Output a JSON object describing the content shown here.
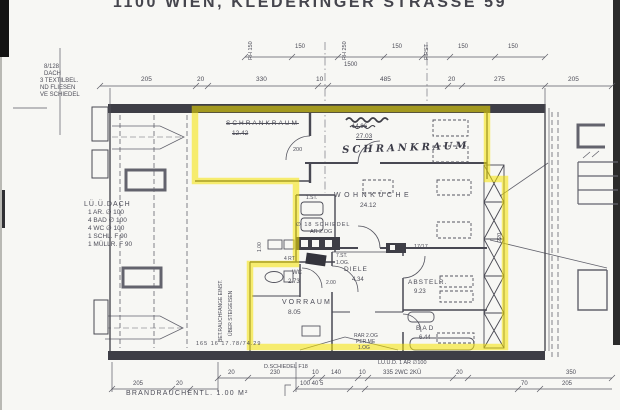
{
  "title": "1100 WIEN, KLEDERINGER STRASSE 59",
  "highlight_color": "#f6e400",
  "ink_color": "#4d4d58",
  "labels": [
    {
      "name": "note-roof-line1",
      "text": "8/128",
      "x": 44,
      "y": 64,
      "size": 6
    },
    {
      "name": "note-roof-line2",
      "text": "DACH",
      "x": 44,
      "y": 71,
      "size": 6
    },
    {
      "name": "note-roof-line3",
      "text": "3 TEXTILBEL.",
      "x": 40,
      "y": 78,
      "size": 6
    },
    {
      "name": "note-roof-line4",
      "text": "ND FLIESEN",
      "x": 40,
      "y": 85,
      "size": 6
    },
    {
      "name": "note-roof-line5",
      "text": "VE SCHIEDEL",
      "x": 40,
      "y": 92,
      "size": 6
    },
    {
      "name": "note-vent-line1",
      "text": "LÜ.Ü.DACH",
      "x": 84,
      "y": 201,
      "size": 7,
      "sp": 1
    },
    {
      "name": "note-vent-line2",
      "text": "1 AR. ∅ 100",
      "x": 88,
      "y": 210,
      "size": 6.5
    },
    {
      "name": "note-vent-line3",
      "text": "4 BAD ∅ 100",
      "x": 88,
      "y": 218,
      "size": 6.5
    },
    {
      "name": "note-vent-line4",
      "text": "4 WC ∅ 100",
      "x": 88,
      "y": 226,
      "size": 6.5
    },
    {
      "name": "note-vent-line5",
      "text": "1 SCHL. F 90",
      "x": 88,
      "y": 234,
      "size": 6.5
    },
    {
      "name": "note-vent-line6",
      "text": "1 MÜLLR. F 90",
      "x": 88,
      "y": 242,
      "size": 6.5
    },
    {
      "name": "dim-rh150",
      "text": "RH 150",
      "x": 249,
      "y": 60,
      "size": 5.5,
      "rot": -90
    },
    {
      "name": "dim-150-a",
      "text": "150",
      "x": 295,
      "y": 44,
      "size": 6
    },
    {
      "name": "dim-rh250",
      "text": "RH 250",
      "x": 343,
      "y": 60,
      "size": 5.5,
      "rot": -90
    },
    {
      "name": "dim-150-b",
      "text": "150",
      "x": 392,
      "y": 44,
      "size": 6
    },
    {
      "name": "dim-first",
      "text": "FIRST",
      "x": 425,
      "y": 60,
      "size": 5.5,
      "rot": -90
    },
    {
      "name": "dim-150-c",
      "text": "150",
      "x": 458,
      "y": 44,
      "size": 6
    },
    {
      "name": "dim-150-d",
      "text": "150",
      "x": 508,
      "y": 44,
      "size": 6
    },
    {
      "name": "dim-1500",
      "text": "1500",
      "x": 344,
      "y": 62,
      "size": 6
    },
    {
      "name": "dim-top-205a",
      "text": "205",
      "x": 141,
      "y": 77,
      "size": 6.5
    },
    {
      "name": "dim-top-20a",
      "text": "20",
      "x": 197,
      "y": 77,
      "size": 6.5
    },
    {
      "name": "dim-top-330",
      "text": "330",
      "x": 256,
      "y": 77,
      "size": 6.5
    },
    {
      "name": "dim-top-10",
      "text": "10",
      "x": 316,
      "y": 77,
      "size": 6.5
    },
    {
      "name": "dim-top-485",
      "text": "485",
      "x": 380,
      "y": 77,
      "size": 6.5
    },
    {
      "name": "dim-top-20b",
      "text": "20",
      "x": 448,
      "y": 77,
      "size": 6.5
    },
    {
      "name": "dim-top-275",
      "text": "275",
      "x": 494,
      "y": 77,
      "size": 6.5
    },
    {
      "name": "dim-top-205b",
      "text": "205",
      "x": 568,
      "y": 77,
      "size": 6.5
    },
    {
      "name": "room-schrankraum1-label",
      "text": "SCHRANKRAUM",
      "x": 226,
      "y": 121,
      "size": 6.5,
      "sp": 2,
      "cls": "strike"
    },
    {
      "name": "room-schrankraum1-area",
      "text": "12.42",
      "x": 232,
      "y": 131,
      "size": 6.5,
      "cls": "strike"
    },
    {
      "name": "door-width-200",
      "text": "200",
      "x": 293,
      "y": 148,
      "size": 5.5
    },
    {
      "name": "room-schrankraum2-old-area",
      "text": "14.96",
      "x": 352,
      "y": 124,
      "size": 6,
      "cls": "strike"
    },
    {
      "name": "room-schrankraum2-area",
      "text": "27.03",
      "x": 356,
      "y": 134,
      "size": 6.5,
      "cls": "under"
    },
    {
      "name": "room-schrankraum2-label",
      "text": "SCHRANKRAUM",
      "x": 342,
      "y": 146,
      "size": 10,
      "sp": 3,
      "rot": -2,
      "cls": "hand"
    },
    {
      "name": "room-wohnkueche-label",
      "text": "WOHNKÜCHE",
      "x": 334,
      "y": 192,
      "size": 7,
      "sp": 3.5
    },
    {
      "name": "room-wohnkueche-area",
      "text": "24.12",
      "x": 360,
      "y": 203,
      "size": 6.5
    },
    {
      "name": "note-schiedel-18",
      "text": "∅ 18 SCHIEDEL",
      "x": 296,
      "y": 223,
      "size": 5.5,
      "sp": 1
    },
    {
      "name": "note-ar-2og",
      "text": "AR 2.OG",
      "x": 310,
      "y": 230,
      "size": 5.5
    },
    {
      "name": "dim-17-17",
      "text": "17/17",
      "x": 414,
      "y": 245,
      "size": 5.5
    },
    {
      "name": "stair-1st",
      "text": "1.ST.",
      "x": 306,
      "y": 196,
      "size": 5
    },
    {
      "name": "stair-7st",
      "text": "7.ST.",
      "x": 336,
      "y": 254,
      "size": 5
    },
    {
      "name": "stair-1og",
      "text": "1.OG.",
      "x": 336,
      "y": 261,
      "size": 5
    },
    {
      "name": "note-4rt",
      "text": "4 RT",
      "x": 284,
      "y": 257,
      "size": 5
    },
    {
      "name": "room-wc-label",
      "text": "WC",
      "x": 292,
      "y": 270,
      "size": 6
    },
    {
      "name": "room-wc-area",
      "text": "2.73",
      "x": 288,
      "y": 279,
      "size": 6
    },
    {
      "name": "room-diele-label",
      "text": "DIELE",
      "x": 344,
      "y": 267,
      "size": 6.5,
      "sp": 1
    },
    {
      "name": "room-diele-area",
      "text": "4.34",
      "x": 352,
      "y": 277,
      "size": 6
    },
    {
      "name": "door-width-200b",
      "text": "2.00",
      "x": 326,
      "y": 281,
      "size": 5
    },
    {
      "name": "room-vorraum-label",
      "text": "VORRAUM",
      "x": 282,
      "y": 299,
      "size": 7,
      "sp": 2
    },
    {
      "name": "room-vorraum-area",
      "text": "8.05",
      "x": 288,
      "y": 310,
      "size": 6.5
    },
    {
      "name": "room-abstellraum-label",
      "text": "ABSTELR.",
      "x": 408,
      "y": 280,
      "size": 6.5,
      "sp": 1
    },
    {
      "name": "room-abstellraum-area",
      "text": "9.23",
      "x": 414,
      "y": 289,
      "size": 6
    },
    {
      "name": "room-bad-label",
      "text": "BAD",
      "x": 416,
      "y": 326,
      "size": 6.5,
      "sp": 2
    },
    {
      "name": "room-bad-area",
      "text": "6.44",
      "x": 419,
      "y": 335,
      "size": 6
    },
    {
      "name": "note-rar-2og",
      "text": "RAR 2.OG",
      "x": 354,
      "y": 334,
      "size": 5
    },
    {
      "name": "note-per-me",
      "text": "PER ME",
      "x": 356,
      "y": 340,
      "size": 5
    },
    {
      "name": "note-1og",
      "text": "1.OG",
      "x": 358,
      "y": 346,
      "size": 5
    },
    {
      "name": "dim-220-vert",
      "text": "220",
      "x": 498,
      "y": 242,
      "size": 5.5,
      "rot": -90
    },
    {
      "name": "dim-100-vert",
      "text": "1.00",
      "x": 258,
      "y": 252,
      "size": 5,
      "rot": -90
    },
    {
      "name": "note-rauchfang",
      "text": "BET.RAUCHFANGE EINST.",
      "x": 219,
      "y": 342,
      "size": 5,
      "rot": -90
    },
    {
      "name": "note-steigeisen",
      "text": "ÜBER STEIGEISEN",
      "x": 229,
      "y": 336,
      "size": 5,
      "rot": -90
    },
    {
      "name": "dim-slab",
      "text": "165 16 17.78/74.29",
      "x": 196,
      "y": 342,
      "size": 5.5,
      "sp": 1
    },
    {
      "name": "note-schiedel-f18",
      "text": "D.SCHIEDEL F18",
      "x": 264,
      "y": 365,
      "size": 5.5
    },
    {
      "name": "note-vent-bottom",
      "text": "LÜ.Ü.D. 1 AR ∅100",
      "x": 378,
      "y": 361,
      "size": 5.5
    },
    {
      "name": "dim-bot-20a",
      "text": "20",
      "x": 228,
      "y": 370,
      "size": 6
    },
    {
      "name": "dim-bot-230",
      "text": "230",
      "x": 270,
      "y": 370,
      "size": 6
    },
    {
      "name": "dim-bot-10a",
      "text": "10",
      "x": 312,
      "y": 370,
      "size": 6
    },
    {
      "name": "dim-bot-140",
      "text": "140",
      "x": 331,
      "y": 370,
      "size": 6
    },
    {
      "name": "dim-bot-10b",
      "text": "10",
      "x": 359,
      "y": 370,
      "size": 6
    },
    {
      "name": "dim-bot-335",
      "text": "335 2WC 2KÜ",
      "x": 383,
      "y": 370,
      "size": 6
    },
    {
      "name": "dim-bot-20b",
      "text": "20",
      "x": 456,
      "y": 370,
      "size": 6
    },
    {
      "name": "dim-bot-350",
      "text": "350",
      "x": 566,
      "y": 370,
      "size": 6
    },
    {
      "name": "dim-bot-100-40-5",
      "text": "100 40 5",
      "x": 300,
      "y": 381,
      "size": 6
    },
    {
      "name": "dim-bot-70",
      "text": "70",
      "x": 521,
      "y": 381,
      "size": 6
    },
    {
      "name": "dim-bot-205a",
      "text": "205",
      "x": 562,
      "y": 381,
      "size": 6
    },
    {
      "name": "dim-bot-205b",
      "text": "205",
      "x": 133,
      "y": 381,
      "size": 6
    },
    {
      "name": "dim-bot-20c",
      "text": "20",
      "x": 176,
      "y": 381,
      "size": 6
    },
    {
      "name": "note-brandrauch",
      "text": "BRANDRAUCHENTL. 1.00 M²",
      "x": 126,
      "y": 390,
      "size": 7,
      "sp": 1.2
    }
  ]
}
